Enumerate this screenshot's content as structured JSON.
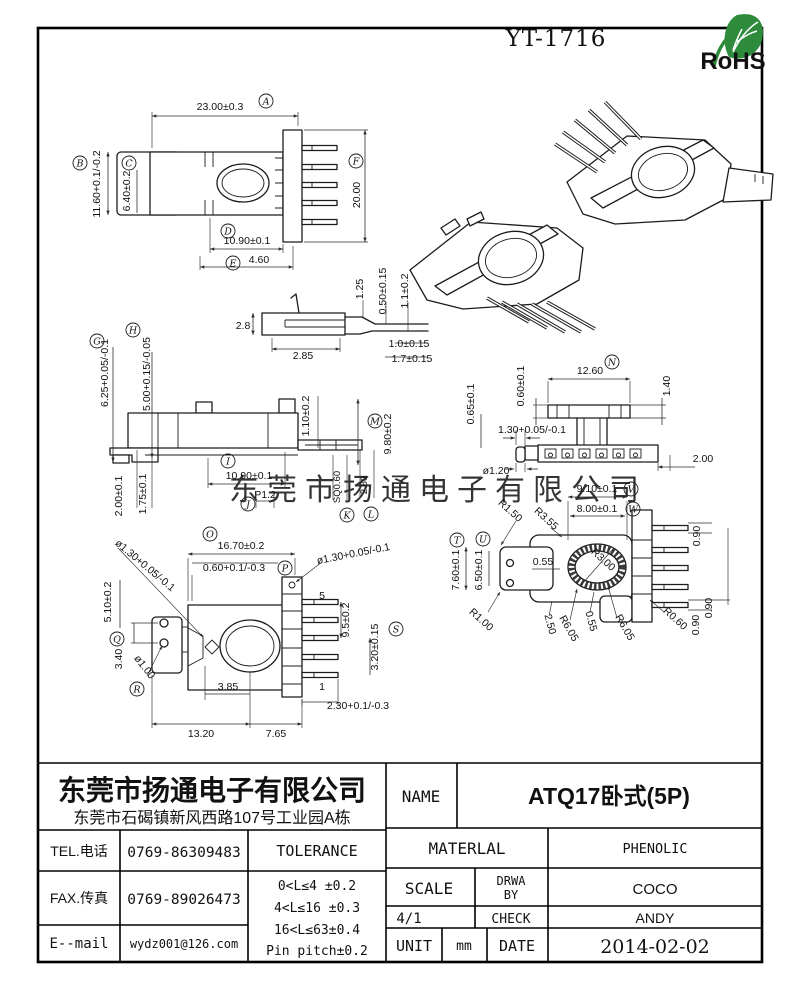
{
  "page": {
    "doc_number": "YT-1716",
    "rohs_label": "RoHS",
    "watermark": "东莞市扬通电子有限公司"
  },
  "colors": {
    "accent_green": "#2e8b3c",
    "watermark_gray": "#c9c9c9",
    "line": "#1c1c1c"
  },
  "letters": {
    "A": "A",
    "B": "B",
    "C": "C",
    "D": "D",
    "E": "E",
    "F": "F",
    "G": "G",
    "H": "H",
    "I": "I",
    "J": "J",
    "K": "K",
    "L": "L",
    "M": "M",
    "N": "N",
    "O": "O",
    "P": "P",
    "Q": "Q",
    "R": "R",
    "S": "S",
    "T": "T",
    "U": "U",
    "V": "V",
    "W": "W"
  },
  "dims": {
    "v1": {
      "A": "23.00±0.3",
      "B": "11.60+0.1/-0.2",
      "C": "6.40±0.2",
      "D": "10.90±0.1",
      "E": "4.60",
      "F": "20.00"
    },
    "v2": {
      "d1": "1.25",
      "d2": "0.50±0.15",
      "d3": "1.1±0.2",
      "d4": "2.8",
      "d5": "2.85",
      "d6": "1.0±0.15",
      "d7": "1.7±0.15"
    },
    "v3": {
      "G": "6.25+0.05/-0.1",
      "H": "5.00+0.15/-0.05",
      "I": "10.90±0.1",
      "J": "P1.2",
      "K": "SQ0.60",
      "L": "2.80",
      "M": "9.80±0.2",
      "d1": "1.10±0.2",
      "d2": "2.00±0.1",
      "d3": "1.75±0.1"
    },
    "v4": {
      "N": "12.60",
      "d1": "0.60±0.1",
      "d2": "0.65±0.1",
      "d3": "1.40",
      "d4": "1.30+0.05/-0.1",
      "d5": "ø1.20",
      "d6": "2.00"
    },
    "v5": {
      "O": "16.70±0.2",
      "P": "0.60+0.1/-0.3",
      "S": "3.20±0.15",
      "d1": "ø1.30+0.05/-0.1",
      "d2": "ø1.30+0.05/-0.1",
      "d3": "5.10±0.2",
      "d4": "3.40",
      "d5": "ø1.00",
      "d6": "3.85",
      "d7": "13.20",
      "d8": "7.65",
      "d9": "9.5±0.2",
      "d10": "2.30+0.1/-0.3",
      "pin_top": "5",
      "pin_bottom": "1"
    },
    "v6": {
      "T": "7.60±0.1",
      "U": "6.50±0.1",
      "V": "9.10±0.1",
      "W": "8.00±0.1",
      "d1": "R1.50",
      "d2": "R3.55",
      "d3": "R3.00",
      "d4": "0.55",
      "d5": "2.50",
      "d6": "R6.05",
      "d7": "0.55",
      "d8": "R6.05",
      "d9": "R1.00",
      "d10": "R0.60",
      "d11": "0.90",
      "d12": "0.90",
      "d13": "0.90"
    }
  },
  "title_block": {
    "company": "东莞市扬通电子有限公司",
    "address": "东莞市石碣镇新风西路107号工业园A栋",
    "tel_label": "TEL.电话",
    "tel": "0769-86309483",
    "fax_label": "FAX.传真",
    "fax": "0769-89026473",
    "email_label": "E--mail",
    "email": "wydz001@126.com",
    "tolerance_label": "TOLERANCE",
    "tolerance_lines": [
      "0<L≤4  ±0.2",
      "4<L≤16 ±0.3",
      "16<L≤63±0.4",
      "Pin pitch±0.2"
    ],
    "name_label": "NAME",
    "name": "ATQ17卧式(5P)",
    "material_label": "MATERLAL",
    "material": "PHENOLIC",
    "scale_label": "SCALE",
    "scale": "4/1",
    "drwa_line1": "DRWA",
    "drwa_line2": "BY",
    "drwa": "COCO",
    "check_label": "CHECK",
    "check": "ANDY",
    "unit_label": "UNIT",
    "unit": "mm",
    "date_label": "DATE",
    "date": "2014-02-02"
  }
}
